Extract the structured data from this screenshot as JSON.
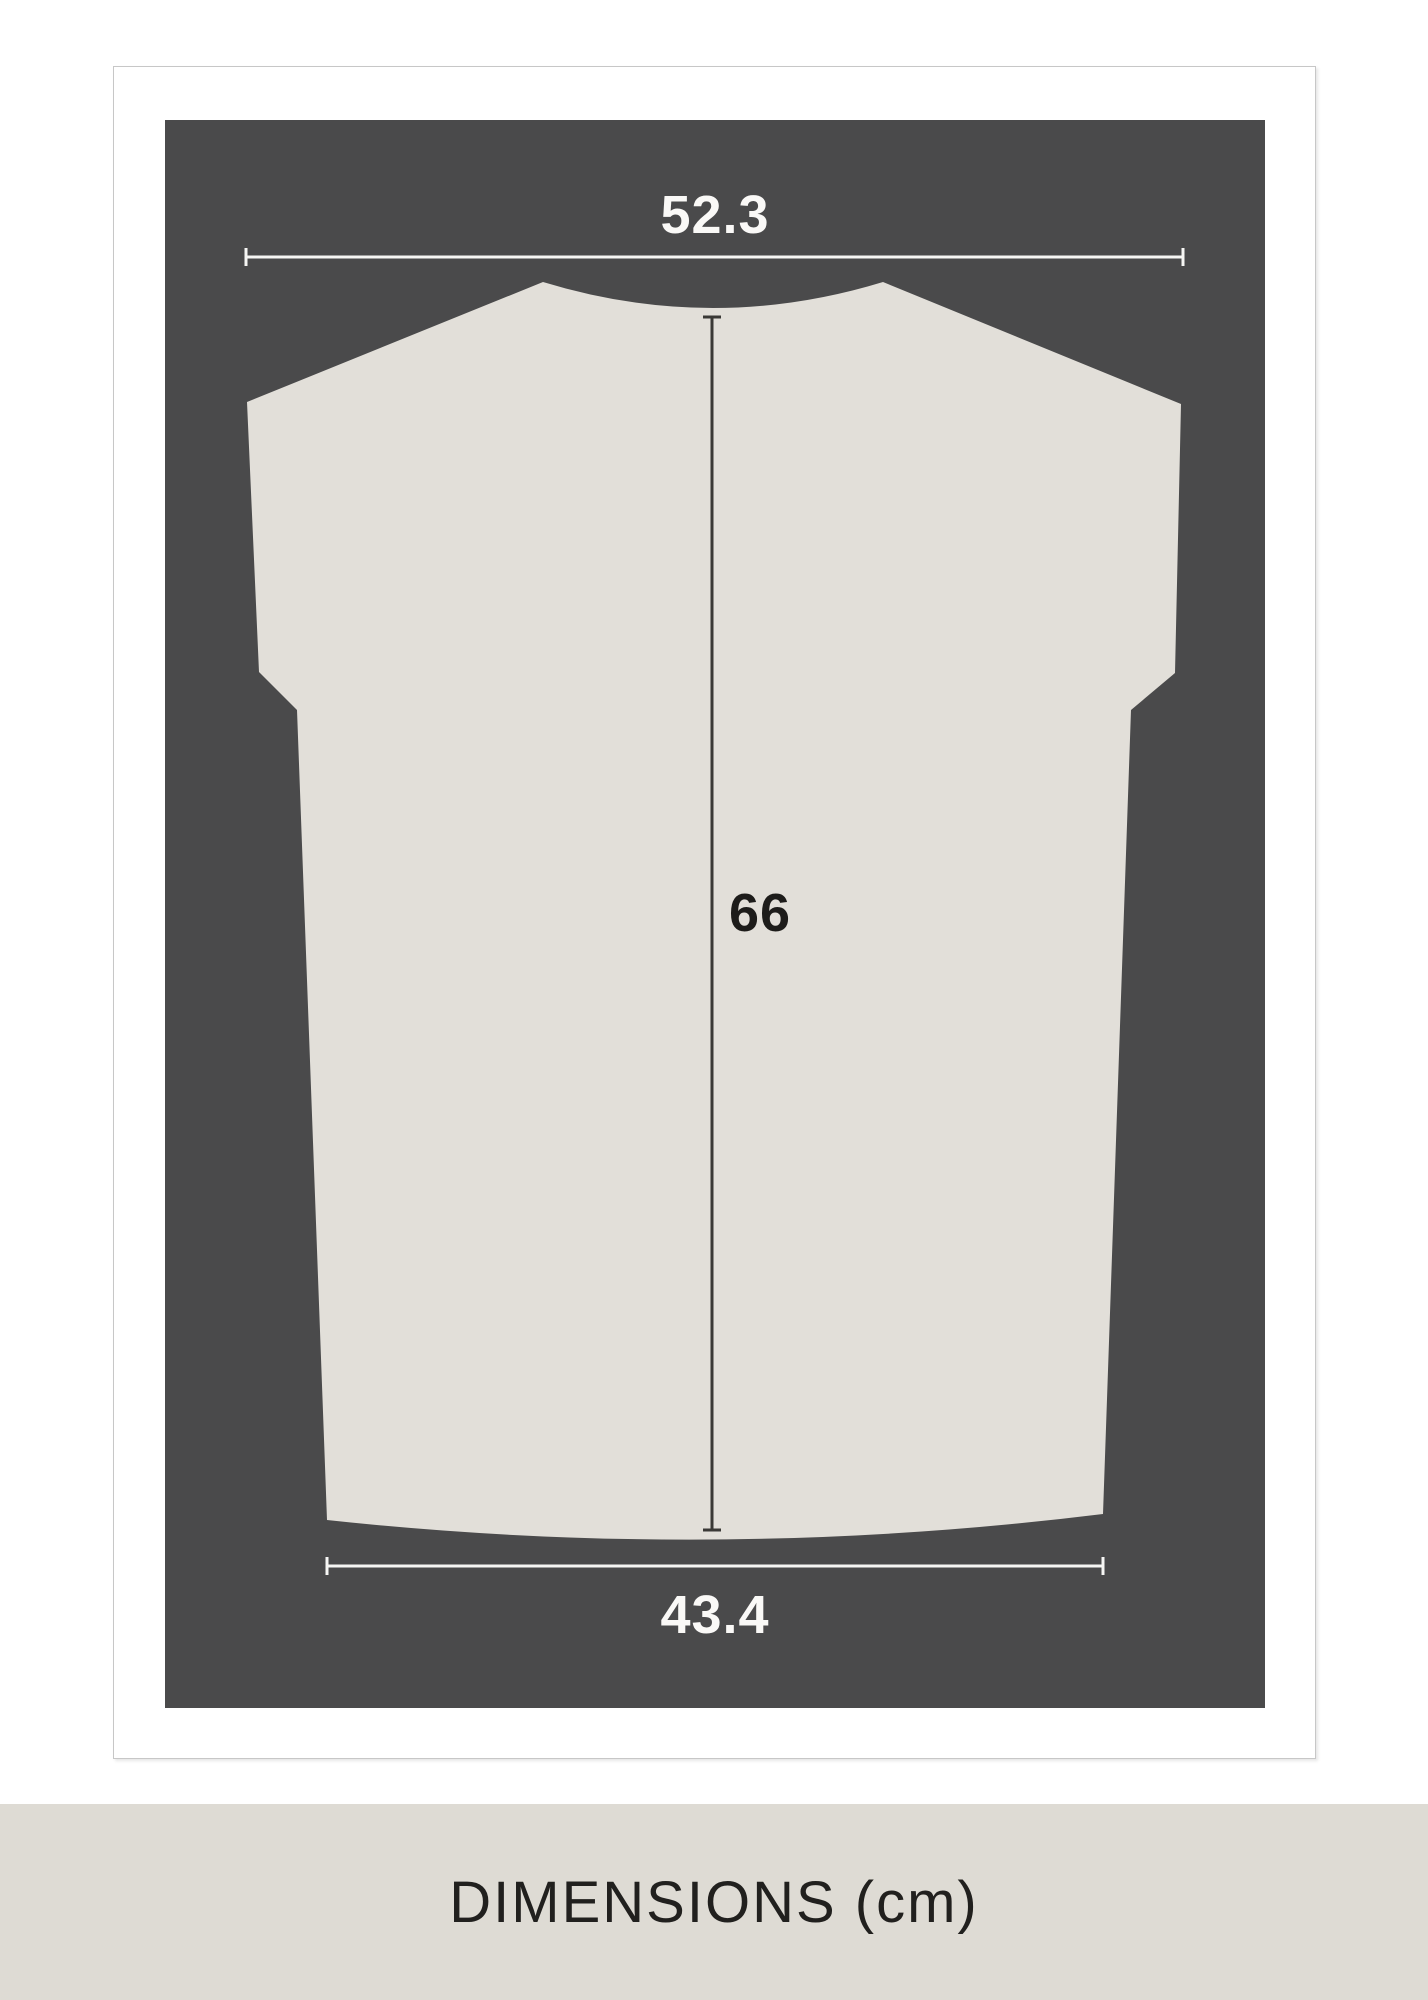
{
  "measurements": {
    "top_width": "52.3",
    "length": "66",
    "bottom_width": "43.4"
  },
  "footer": {
    "caption": "DIMENSIONS (cm)"
  },
  "icons": {
    "garment": "t-shirt-back-silhouette"
  },
  "colors": {
    "panel_background": "#4a4a4b",
    "garment_fill": "#e2dfd9",
    "card_background": "#ffffff",
    "card_border": "#c7c7c7",
    "footer_background": "#dedbd4",
    "light_line": "#f6f6f4",
    "dark_line": "#3a3936",
    "dark_text": "#1d1c1a",
    "light_text": "#faf9f7"
  }
}
